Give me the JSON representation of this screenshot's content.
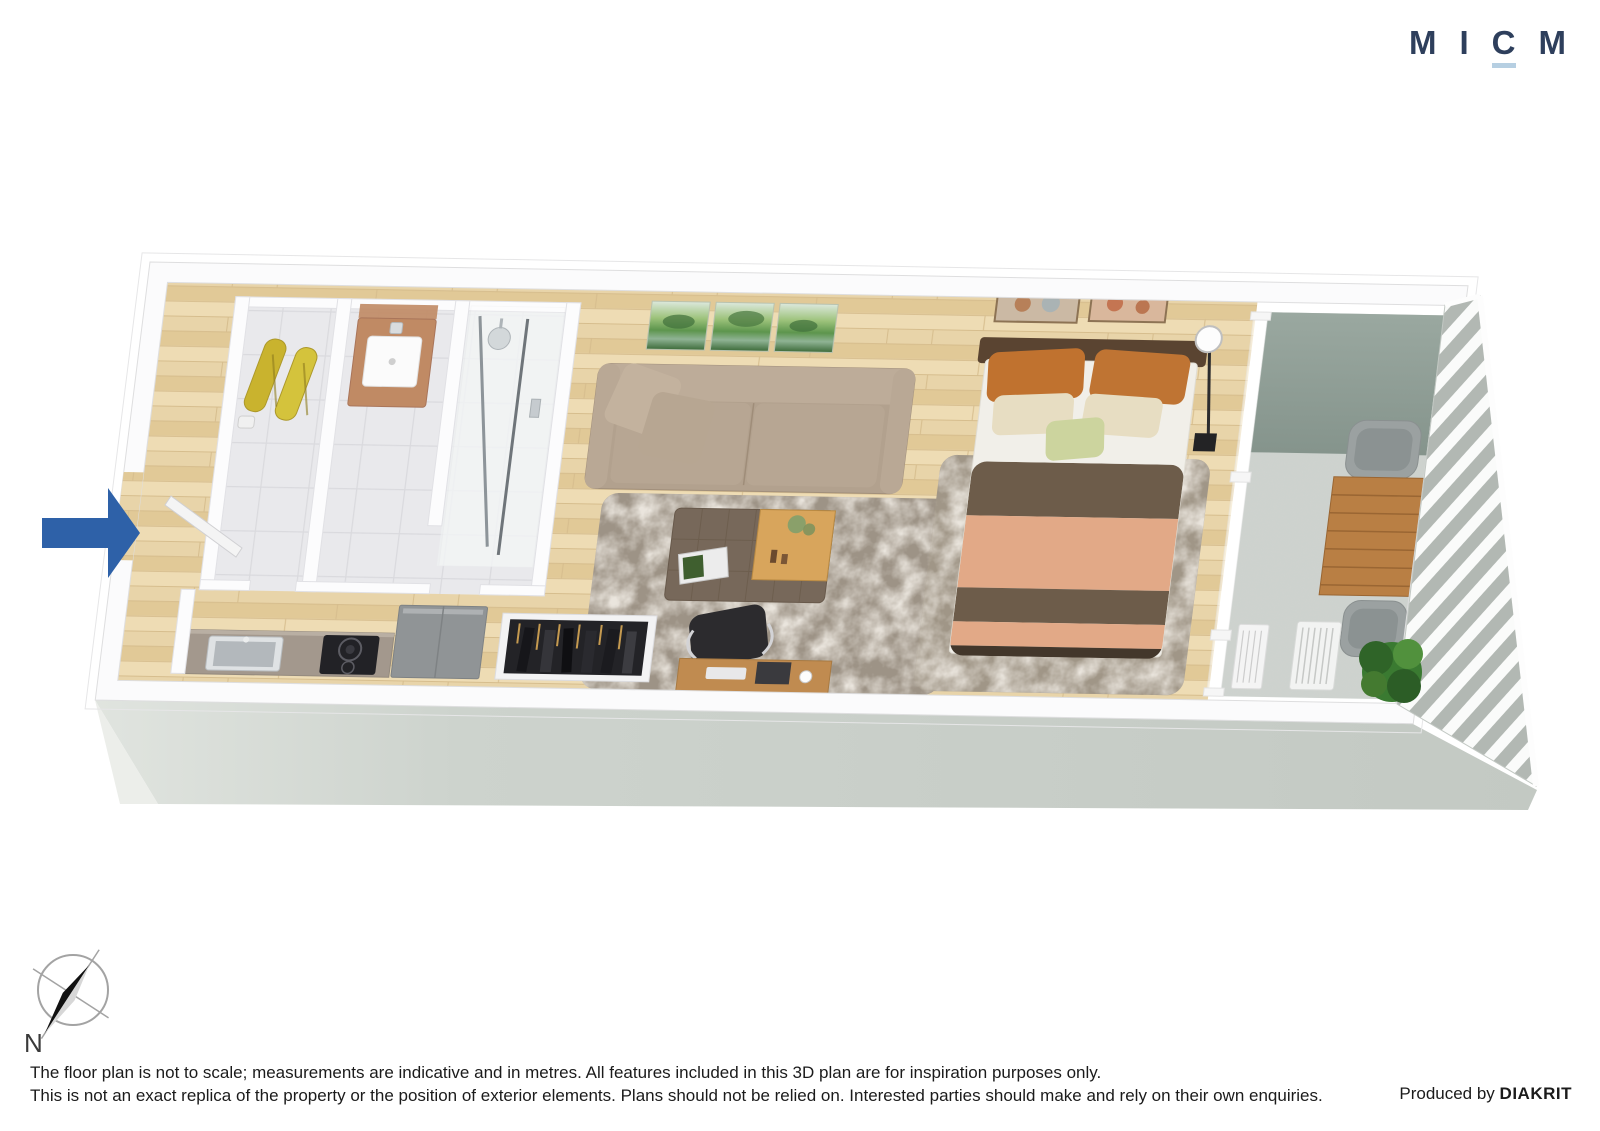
{
  "brand": {
    "letters": [
      "M",
      "I",
      "C",
      "M"
    ],
    "name": "MICM"
  },
  "compass": {
    "label": "N"
  },
  "footer": {
    "disclaimer_line1": "The floor plan is not to scale; measurements are indicative and in metres. All features included in this 3D plan are for inspiration purposes only.",
    "disclaimer_line2": "This is not an exact replica of the property or the position of exterior elements. Plans should not be relied on. Interested parties should make and rely on their own enquiries.",
    "produced_by": "Produced by",
    "producer": "DIAKRIT"
  },
  "palette": {
    "navy": "#2e3f5c",
    "logo-underline": "#b6cfe2",
    "arrow-blue": "#2e61a8",
    "ink": "#1b1b1b",
    "wall-face": "#c6ccc6",
    "wood-floor": "#e8d4a9",
    "sage-wall": "#8f9e96",
    "rug-gray": "#a29889",
    "sofa-beige": "#b2a18e",
    "duvet-salmon": "#e2a987",
    "duvet-brown": "#6d5c4a",
    "towel-yellow": "#c9b32e"
  },
  "floorplan": {
    "view": "3D isometric studio apartment floor plan",
    "rooms_visible": [
      "entry hall",
      "bathroom with vanity",
      "shower room",
      "kitchen",
      "living area",
      "sleeping area",
      "balcony"
    ],
    "furniture_visible": [
      "yellow towels",
      "toilet roll holder",
      "copper vanity sink",
      "shower",
      "kitchen counter with sink and cooktop",
      "refrigerator",
      "open wardrobe with clothes",
      "desk with office chair and laptop",
      "beige sofa with cushions",
      "triptych landscape painting",
      "ottoman coffee table with wooden tray and magazine",
      "two shag rugs",
      "double bed with striped duvet and pillows",
      "floor lamp",
      "two framed artworks",
      "sliding glass door",
      "outdoor timber table",
      "two outdoor chairs",
      "air-conditioning unit",
      "green plant",
      "slatted balcony railing"
    ],
    "entry_marker": "blue arrow at left exterior wall"
  }
}
